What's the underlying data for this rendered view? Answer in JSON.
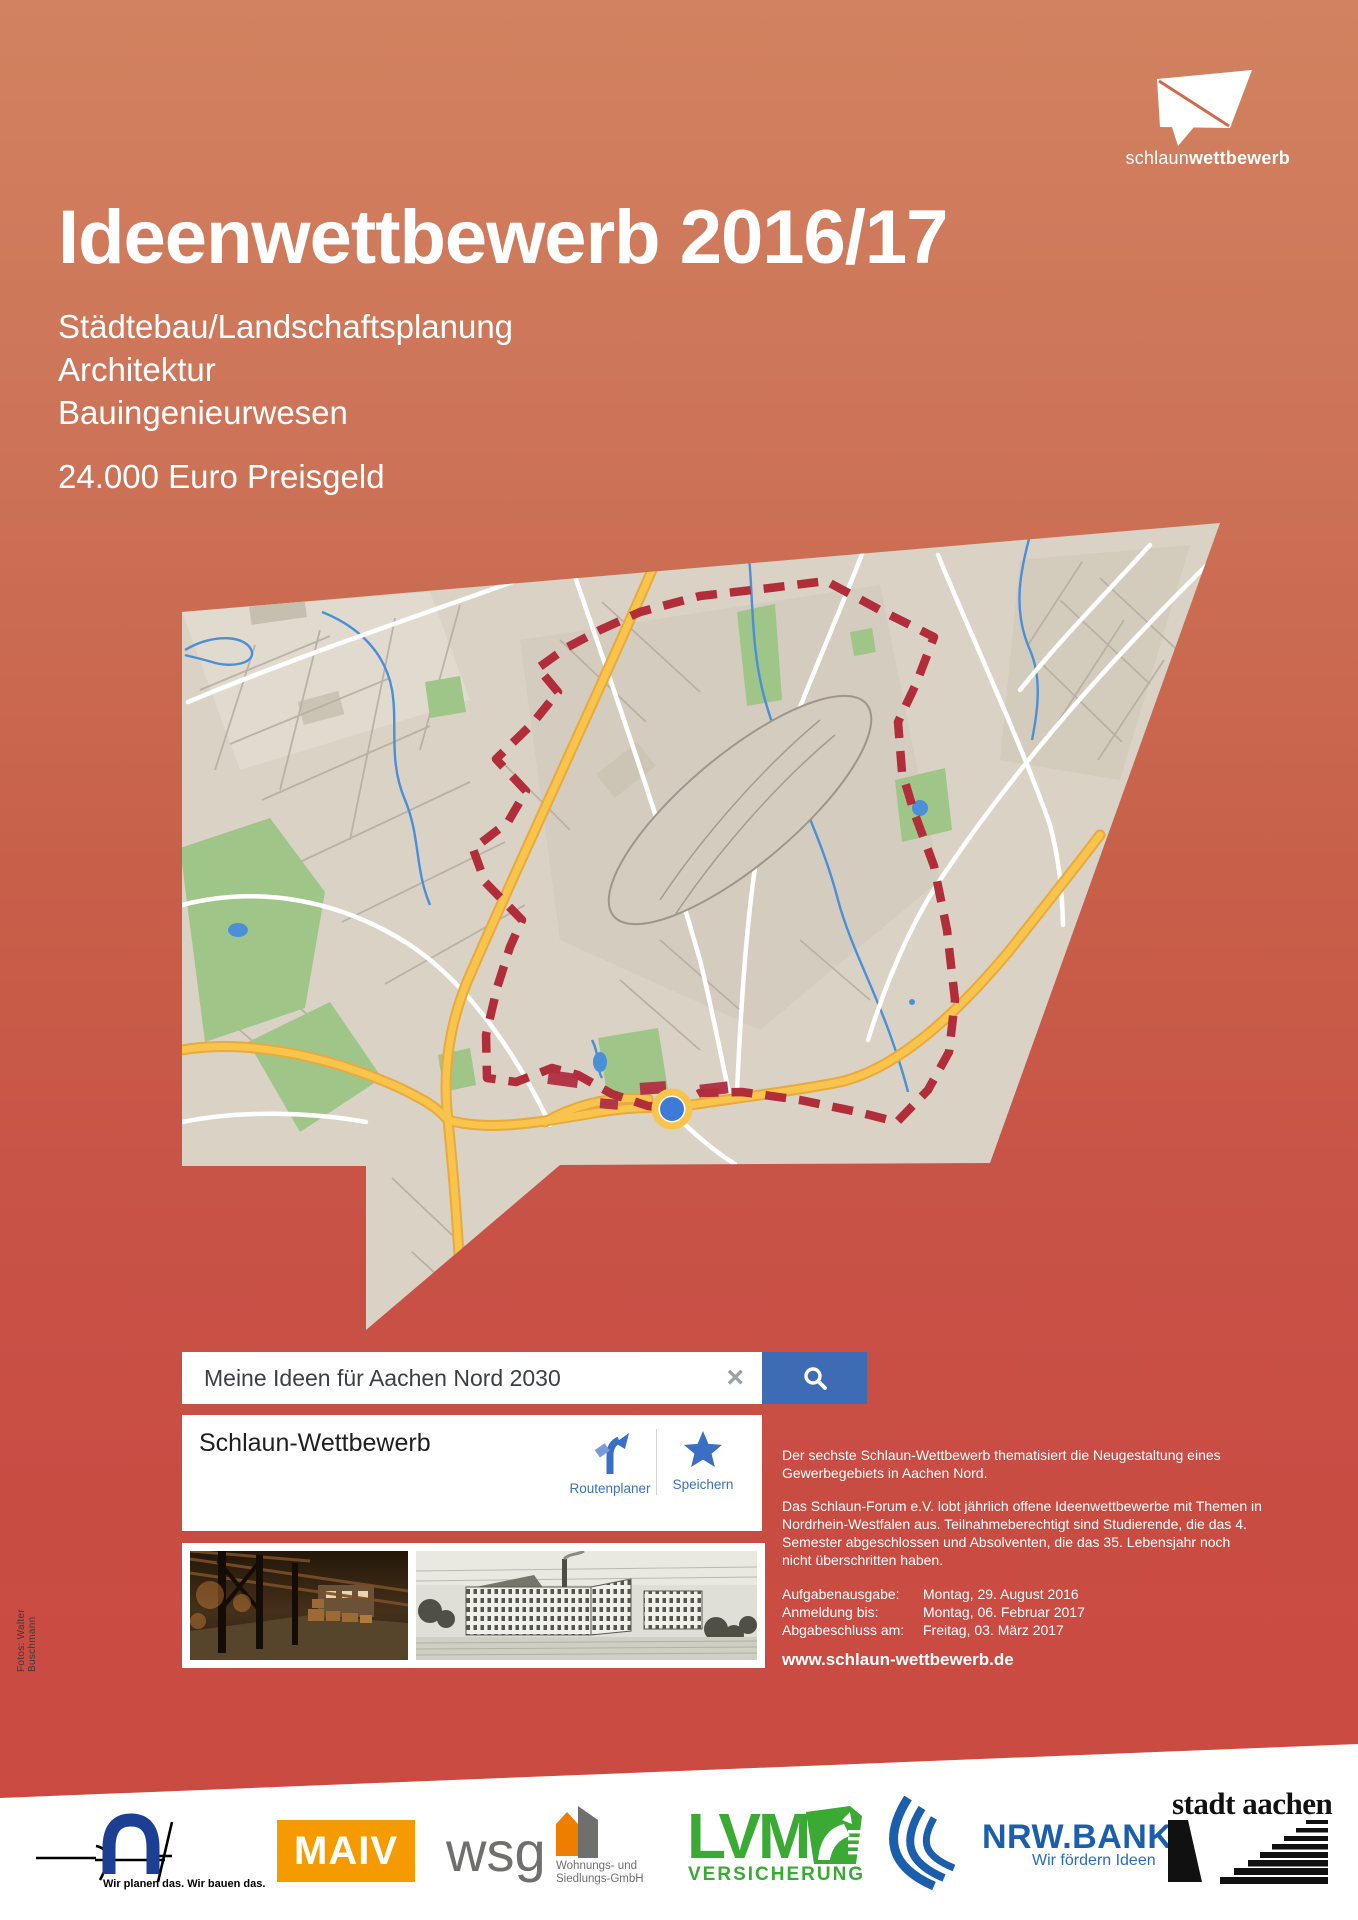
{
  "brand": {
    "logo_regular": "schlaun",
    "logo_bold": "wettbewerb"
  },
  "header": {
    "title": "Ideenwettbewerb 2016/17",
    "disciplines": [
      "Städtebau/Landschaftsplanung",
      "Architektur",
      "Bauingenieurwesen"
    ],
    "prize": "24.000 Euro Preisgeld"
  },
  "search": {
    "query": "Meine Ideen für Aachen Nord 2030",
    "clear_icon": "×"
  },
  "place_card": {
    "title": "Schlaun-Wettbewerb",
    "actions": [
      {
        "label": "Routenplaner"
      },
      {
        "label": "Speichern"
      }
    ]
  },
  "details": {
    "intro": "Der sechste Schlaun-Wettbewerb thematisiert die Neugestaltung eines Gewerbegebiets in Aachen Nord.",
    "body": "Das Schlaun-Forum e.V. lobt jährlich offene Ideenwettbewerbe mit Themen in Nordrhein-Westfalen aus. Teilnahmeberechtigt sind Studierende, die das 4. Semester abgeschlossen und Absolventen, die das 35. Lebensjahr noch nicht überschritten haben.",
    "dates": [
      {
        "label": "Aufgabenausgabe:",
        "value": "Montag, 29. August 2016"
      },
      {
        "label": "Anmeldung bis:",
        "value": "Montag, 06. Februar 2017"
      },
      {
        "label": "Abgabeschluss am:",
        "value": "Freitag, 03. März 2017"
      }
    ],
    "website": "www.schlaun-wettbewerb.de"
  },
  "photo_credit": "Fotos: Walter Buschmann",
  "sponsors": {
    "architects_slogan": "Wir planen das. Wir bauen das.",
    "maiv": "MAIV",
    "wsg": "wsg",
    "wsg_caption_line1": "Wohnungs- und",
    "wsg_caption_line2": "Siedlungs-GmbH",
    "lvm": "LVM",
    "lvm_sub": "VERSICHERUNG",
    "nrw_bank": "NRW.BANK",
    "nrw_bank_slogan": "Wir fördern Ideen",
    "stadt_aachen": "stadt aachen"
  },
  "colors": {
    "background_top": "#d28260",
    "background_bottom": "#cb4a42",
    "search_button_blue": "#3d6cb4",
    "link_blue": "#3b6fc4",
    "boundary_red": "#b22d3a",
    "map_base": "#d9d2c5",
    "road_yellow": "#f7c24a",
    "maiv_orange": "#f59b00",
    "lvm_green": "#3aaa35",
    "nrw_blue": "#1b5eab"
  }
}
